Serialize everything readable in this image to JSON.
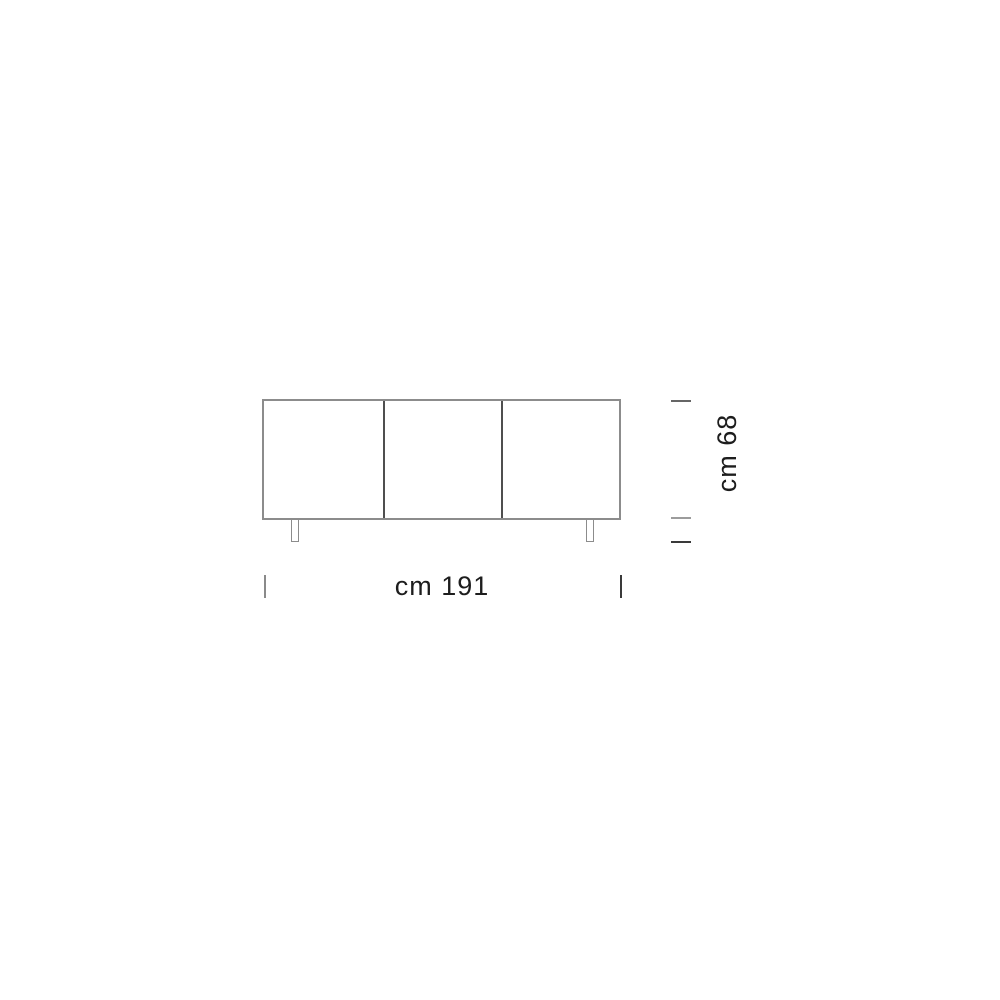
{
  "drawing": {
    "type": "furniture-dimension-diagram",
    "subject": "three-door sideboard front elevation",
    "door_count": 3,
    "leg_count": 2,
    "width_label": "cm 191",
    "height_label": "cm 68",
    "width_value_cm": 191,
    "height_value_cm": 68,
    "colors": {
      "background": "#ffffff",
      "outline_gray": "#8c8c8c",
      "divider_gray": "#4f4f4f",
      "tick_dark": "#3a3a3a",
      "tick_light": "#9c9c9c",
      "text": "#1d1d1d"
    }
  }
}
